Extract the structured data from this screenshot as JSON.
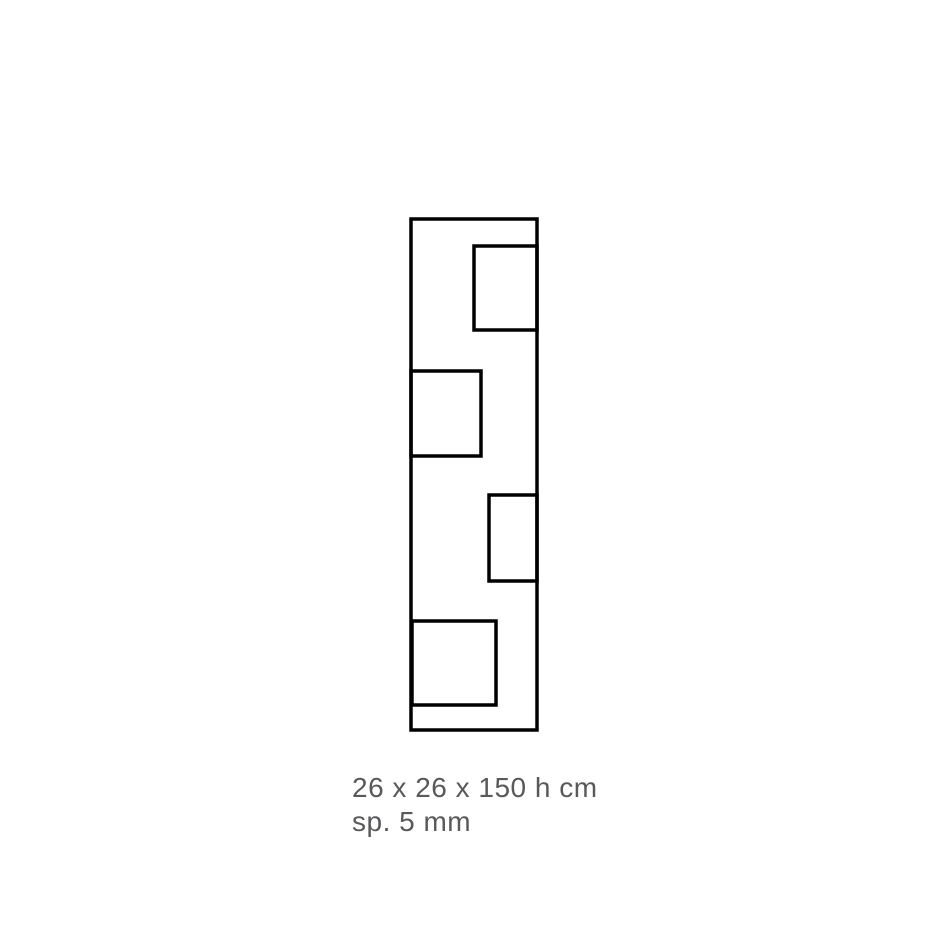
{
  "page": {
    "background": "#ffffff"
  },
  "figure": {
    "stroke_color": "#000000",
    "stroke_width": 3.5,
    "outline": {
      "x": 411,
      "y": 219,
      "width": 126,
      "height": 511
    },
    "openings": [
      {
        "x": 474,
        "y": 246,
        "width": 63,
        "height": 84
      },
      {
        "x": 411,
        "y": 371,
        "width": 70,
        "height": 85
      },
      {
        "x": 489,
        "y": 495,
        "width": 48,
        "height": 86
      },
      {
        "x": 412,
        "y": 621,
        "width": 84,
        "height": 84
      }
    ]
  },
  "caption": {
    "dimensions": "26 x 26 x 150 h cm",
    "thickness": "sp. 5 mm",
    "color": "#58595b"
  }
}
